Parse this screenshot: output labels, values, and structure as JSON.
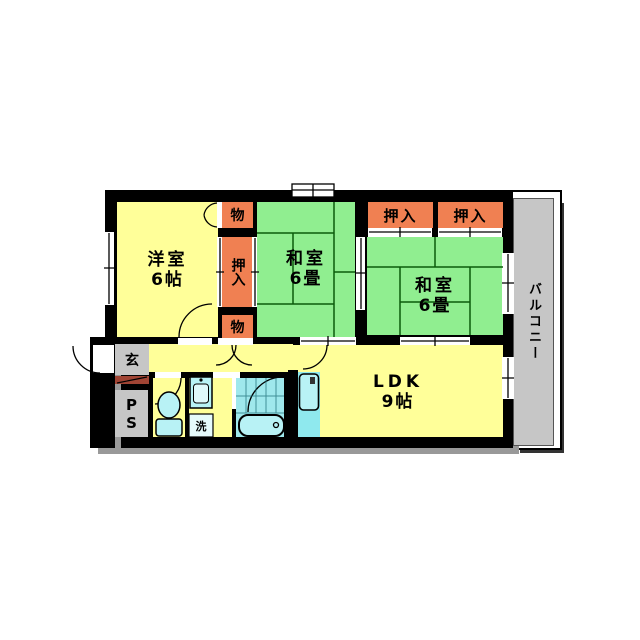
{
  "meta": {
    "type": "floor-plan",
    "description": "Japanese apartment floor plan, 2LDK with balcony"
  },
  "rooms": {
    "western": {
      "name": "洋室",
      "size": "6帖"
    },
    "washitsu_center": {
      "name": "和室",
      "size": "6畳"
    },
    "washitsu_right": {
      "name": "和室",
      "size": "6畳"
    },
    "ldk": {
      "name": "LDK",
      "size": "9帖"
    },
    "balcony": {
      "name": "バルコニー"
    },
    "entrance": {
      "name": "玄"
    },
    "pipe_space": {
      "name": "PS"
    },
    "laundry": {
      "name": "洗"
    },
    "storage_top": {
      "name": "物"
    },
    "storage_bottom": {
      "name": "物"
    },
    "oshiire_center": {
      "name": "押入"
    },
    "oshiire_right_1": {
      "name": "押入"
    },
    "oshiire_right_2": {
      "name": "押入"
    }
  },
  "fixtures": {
    "toilet": "toilet-icon",
    "bathtub": "bathtub-icon",
    "washbasin": "washbasin-icon",
    "kitchen_sink": "kitchen-sink-icon",
    "washing_machine": "washing-machine-box",
    "doors": "door-swing-arc",
    "windows": "window-symbol"
  },
  "colors": {
    "wall": "#000000",
    "room_yellow": "#FFFF99",
    "tatami_green": "#90EE90",
    "tatami_line": "#0B5B0B",
    "closet_orange": "#F08052",
    "water_cyan": "#B8F2F5",
    "bath_floor": "#9FE8EC",
    "counter_cyan": "#8FE9EE",
    "gray": "#C6C6C6",
    "step_red": "#A04434",
    "shadow": "#999999"
  }
}
